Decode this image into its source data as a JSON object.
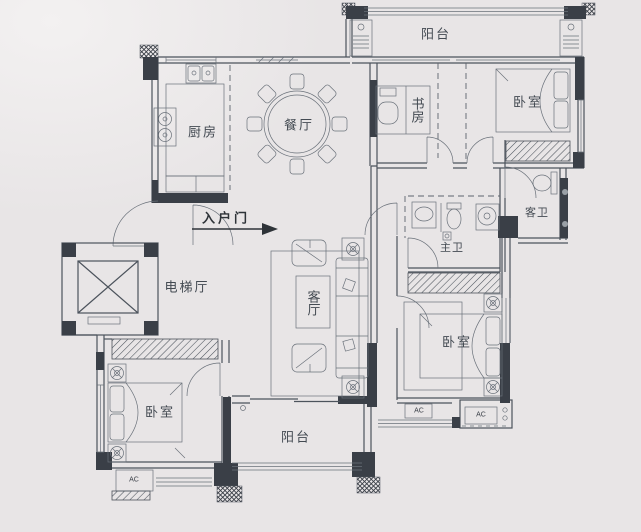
{
  "image_type": "apartment floor plan drawing",
  "colors": {
    "background": "#e8e5e6",
    "line": "#4c535c",
    "wall_fill": "#3a3f47",
    "text": "#434a52"
  },
  "rooms": {
    "balcony_top": "阳台",
    "kitchen": "厨房",
    "dining_room": "餐厅",
    "study": "书房",
    "bedroom_top_right": "卧室",
    "guest_bathroom": "客卫",
    "master_bathroom": "主卫",
    "entrance_door": "入户门",
    "elevator_hall": "电梯厅",
    "living_room": "客厅",
    "bedroom_right": "卧室",
    "bedroom_bottom_left": "卧室",
    "balcony_bottom": "阳台"
  },
  "equipment_labels": {
    "ac_unit_right_1": "AC",
    "ac_unit_right_2": "AC",
    "ac_unit_bottom_left": "AC"
  }
}
